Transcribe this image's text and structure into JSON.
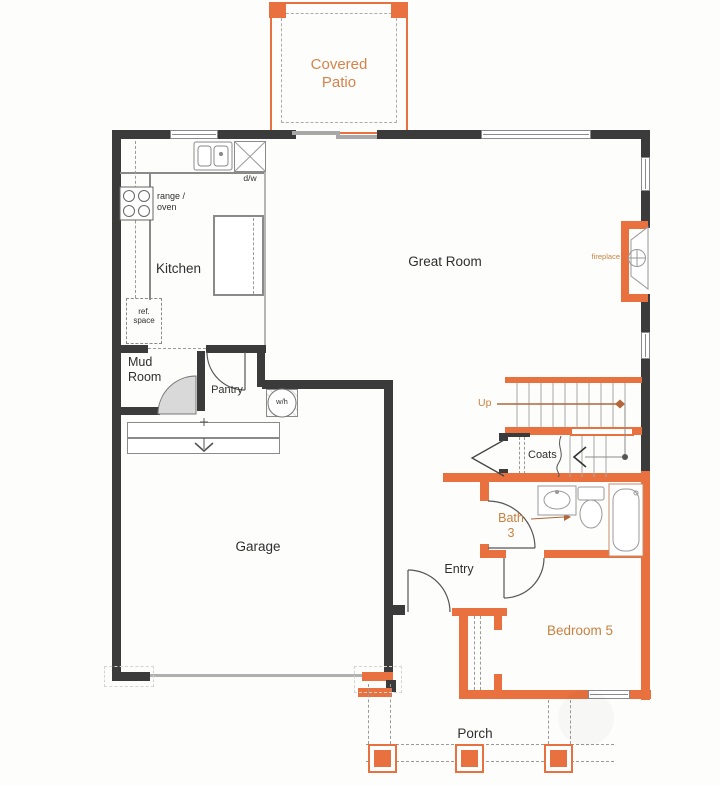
{
  "title": "First floor plan",
  "colors": {
    "wall_dark": "#3b3b3b",
    "wall_orange": "#e8713f",
    "orange_text": "#c8813f",
    "patio_text": "#d5834a",
    "line_gray": "#8a8a8a"
  },
  "rooms": {
    "covered_patio": "Covered Patio",
    "kitchen": "Kitchen",
    "great_room": "Great Room",
    "mud_room": "Mud Room",
    "pantry": "Pantry",
    "garage": "Garage",
    "entry": "Entry",
    "coats": "Coats",
    "bath_3": "Bath 3",
    "bedroom_5": "Bedroom 5",
    "porch": "Porch"
  },
  "annotations": {
    "dishwasher": "d/w",
    "water_heater": "w/h",
    "range_oven": "range / oven",
    "ref_space": "ref. space",
    "fireplace": "fireplace",
    "stairs_up": "Up"
  }
}
